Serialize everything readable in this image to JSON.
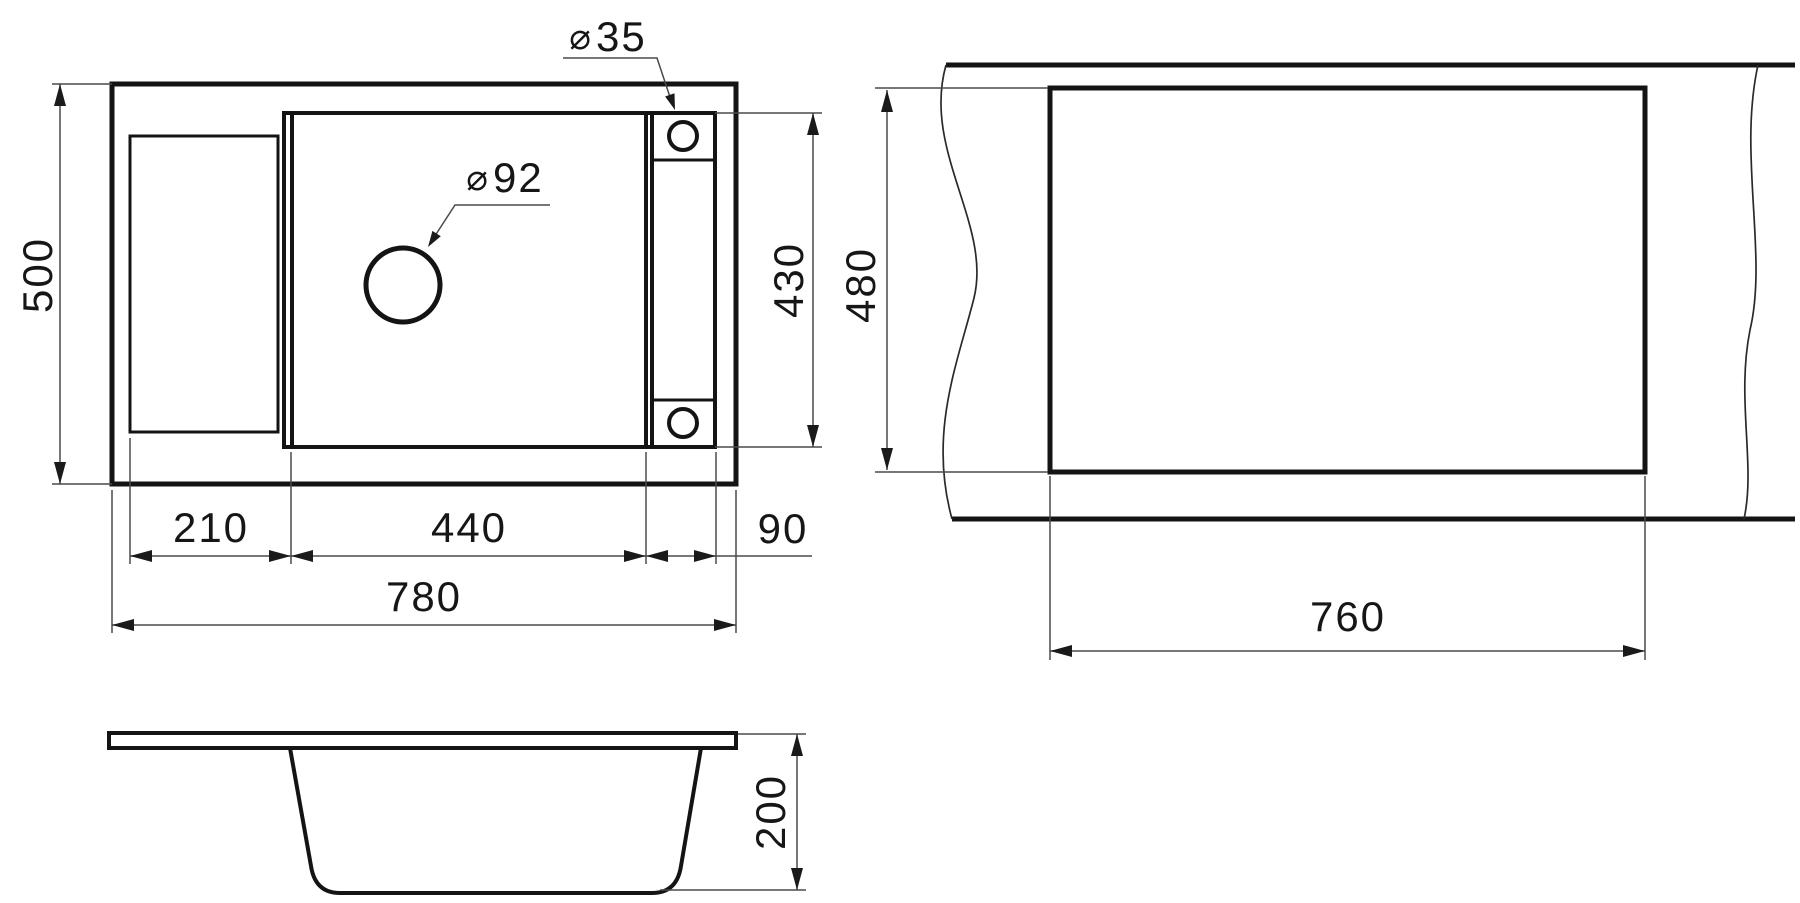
{
  "colors": {
    "background": "#ffffff",
    "line": "#141414",
    "thin_line": "#4a4a4a",
    "text": "#161616"
  },
  "plan_view": {
    "overall_depth": "500",
    "bowl_inner_depth": "430",
    "drainer_width": "210",
    "bowl_width": "440",
    "tap_deck_width": "90",
    "overall_width": "780",
    "tap_hole": {
      "symbol": "⌀",
      "diameter": "35"
    },
    "drain_hole": {
      "symbol": "⌀",
      "diameter": "92"
    }
  },
  "cutout_view": {
    "cutout_height": "480",
    "cutout_width": "760"
  },
  "section_view": {
    "bowl_height": "200"
  }
}
